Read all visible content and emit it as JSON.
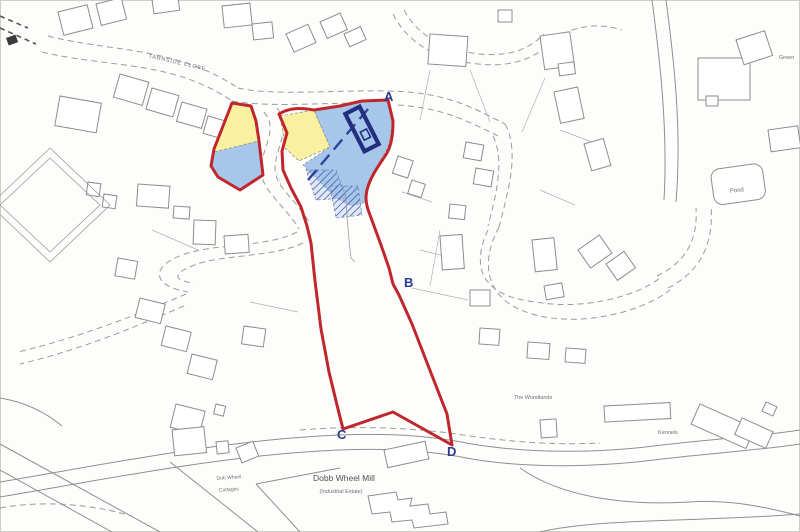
{
  "map": {
    "markers": {
      "a": "A",
      "b": "B",
      "c": "C",
      "d": "D"
    },
    "labels": {
      "tarnside_close": "TARNSIDE CLOSE",
      "road_name_illegible": "··········",
      "pond": "Pond",
      "the_woodlands": "The Woodlands",
      "kennels": "Kennels",
      "green_partial": "Green",
      "dobb_wheel_mill": "Dobb Wheel Mill",
      "industrial_estate": "(Industrial Estate)",
      "dob_wheel_cottages_line1": "Dob Wheel",
      "dob_wheel_cottages_line2": "Cottages"
    },
    "legend_colors": {
      "site_boundary_red": "#c0272d",
      "area_yellow": "#f9f0a0",
      "area_blue": "#a7c7ea",
      "hatch_navy": "#3b4da6",
      "marker_navy": "#2c3a8f"
    }
  }
}
